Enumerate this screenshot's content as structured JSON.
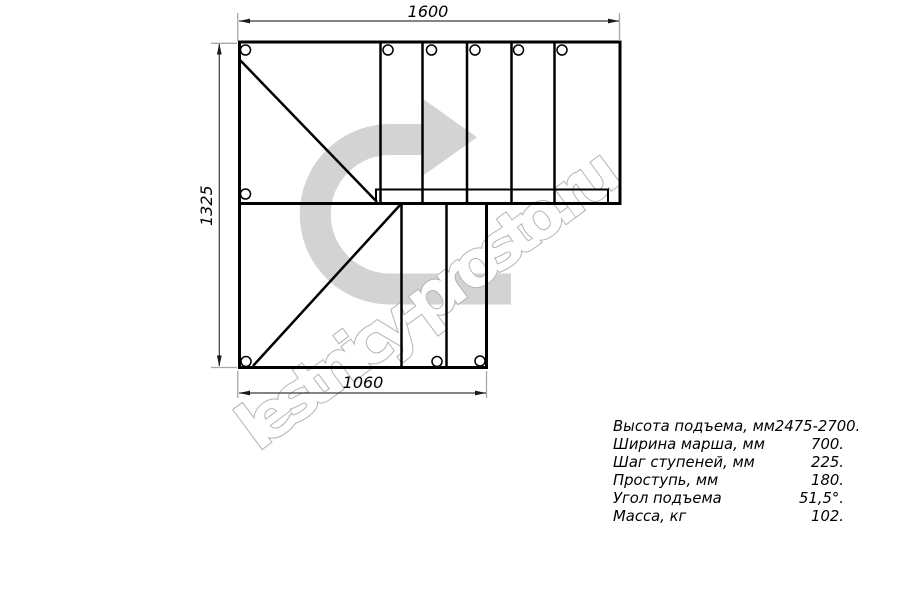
{
  "drawing": {
    "type": "staircase-plan-top-view",
    "dim_top": "1600",
    "dim_left": "1325",
    "dim_bottom": "1060",
    "watermark": "lestnicy-prosto.ru"
  },
  "specs": {
    "rows": [
      {
        "label": "Высота подъема, мм",
        "value": "2475-2700."
      },
      {
        "label": "Ширина марша, мм",
        "value": "700."
      },
      {
        "label": "Шаг ступеней, мм",
        "value": "225."
      },
      {
        "label": "Проступь, мм",
        "value": "180."
      },
      {
        "label": "Угол подъема",
        "value": "51,5°."
      },
      {
        "label": "Масса, кг",
        "value": "102."
      }
    ]
  },
  "colors": {
    "background": "#ffffff",
    "drawing_line": "#000000",
    "dimension_line": "#3a3a3a",
    "extension_line": "#a8a8a8",
    "direction_arrow": "#d3d3d3",
    "watermark_outline": "#b3b3b3"
  }
}
